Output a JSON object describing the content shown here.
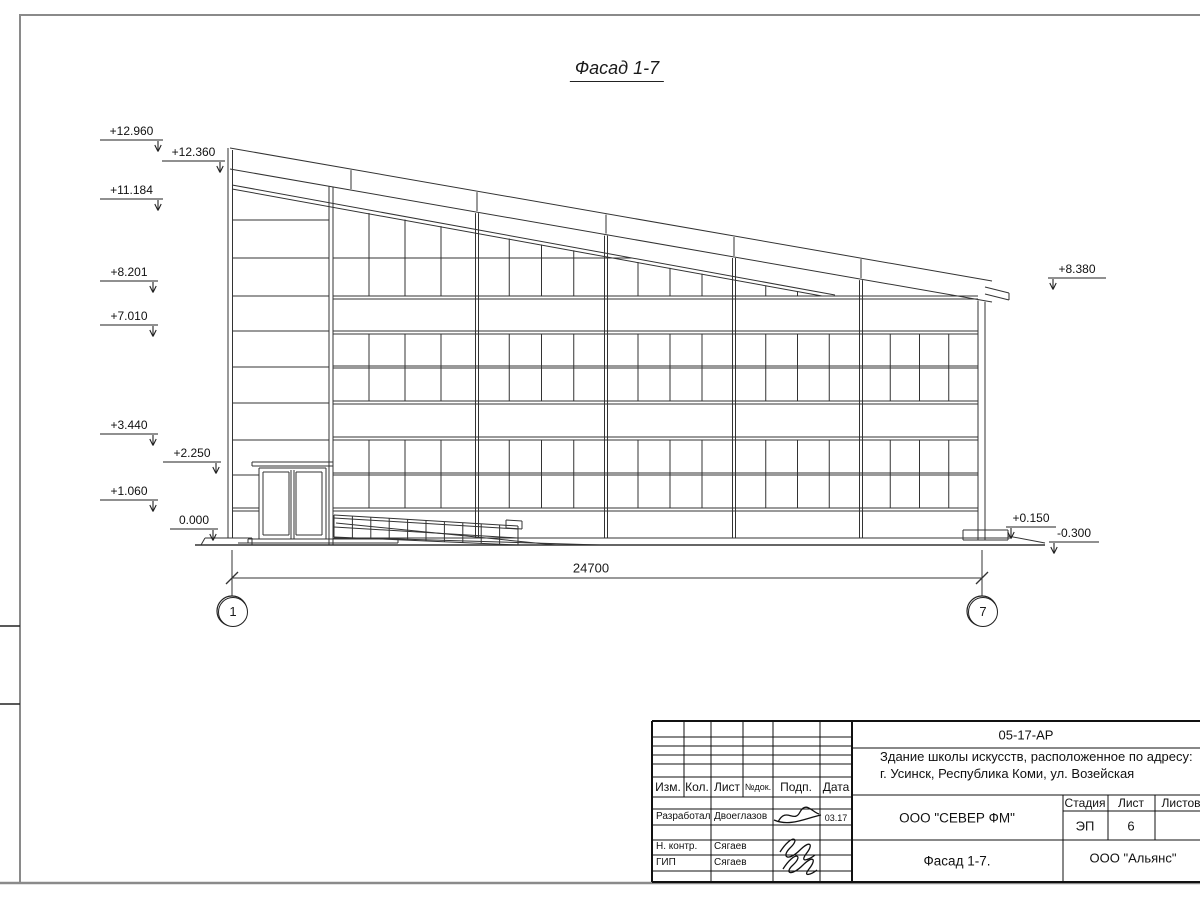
{
  "drawing": {
    "title": "Фасад 1-7",
    "dimension_total": "24700",
    "axes": [
      "1",
      "7"
    ],
    "elevations": [
      "+12.960",
      "+12.360",
      "+11.184",
      "+8.201",
      "+7.010",
      "+3.440",
      "+2.250",
      "+1.060",
      "0.000",
      "+8.380",
      "+0.150",
      "-0.300"
    ]
  },
  "title_block": {
    "document_code": "05-17-АР",
    "project_line1": "Здание школы искусств, расположенное по адресу:",
    "project_line2": "г. Усинск, Республика Коми, ул. Возейская",
    "designer_company": "ООО \"СЕВЕР ФМ\"",
    "sheet_name": "Фасад 1-7.",
    "client_company": "ООО \"Альянс\"",
    "stage_label": "Стадия",
    "stage_value": "ЭП",
    "sheet_label": "Лист",
    "sheet_value": "6",
    "sheets_label": "Листов",
    "sheets_value": "",
    "columns": {
      "izm": "Изм.",
      "kol": "Кол.",
      "list": "Лист",
      "doc": "№док.",
      "sign": "Подп.",
      "date": "Дата"
    },
    "staff": [
      {
        "role": "Разработал",
        "name": "Двоеглазов",
        "date": "03.17"
      },
      {
        "role": "Н. контр.",
        "name": "Сягаев",
        "date": ""
      },
      {
        "role": "ГИП",
        "name": "Сягаев",
        "date": ""
      }
    ]
  }
}
